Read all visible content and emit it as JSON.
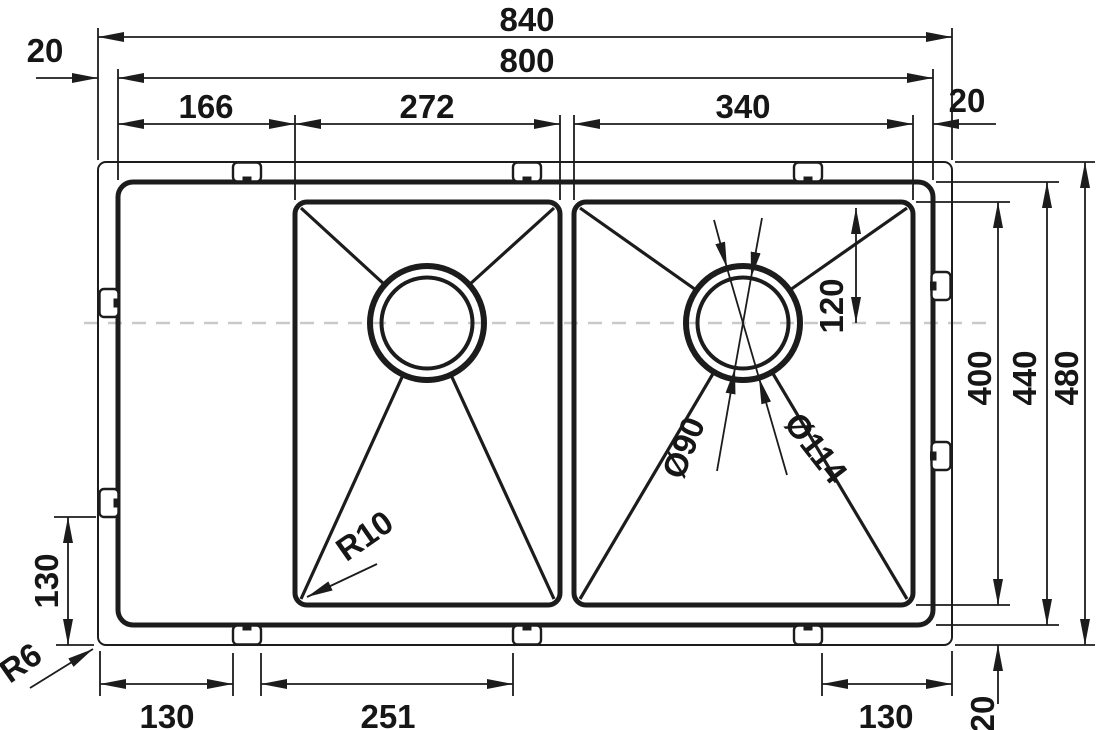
{
  "drawing": {
    "type": "technical-dimension-drawing",
    "subject": "double-bowl kitchen sink with drainboard, top view",
    "line_color": "#1c1c1c",
    "centerline_color": "#c9c9c9",
    "background": "#ffffff"
  },
  "dims": {
    "overall_width": "840",
    "body_width": "800",
    "overhang_left": "20",
    "overhang_right": "20",
    "drainboard_width": "166",
    "middle_bowl_width": "272",
    "right_bowl_width": "340",
    "drain_offset": "120",
    "bowl_depth": "400",
    "body_depth": "440",
    "overall_depth": "480",
    "overhang_bottom": "20",
    "clip_offset_left": "130",
    "clip_left_span": "130",
    "clip_mid_span": "251",
    "clip_right_span": "130",
    "flange_corner_radius": "R6",
    "bowl_corner_radius": "R10",
    "drain_hole_diameter": "Ø90",
    "drain_flange_diameter": "Ø114"
  }
}
